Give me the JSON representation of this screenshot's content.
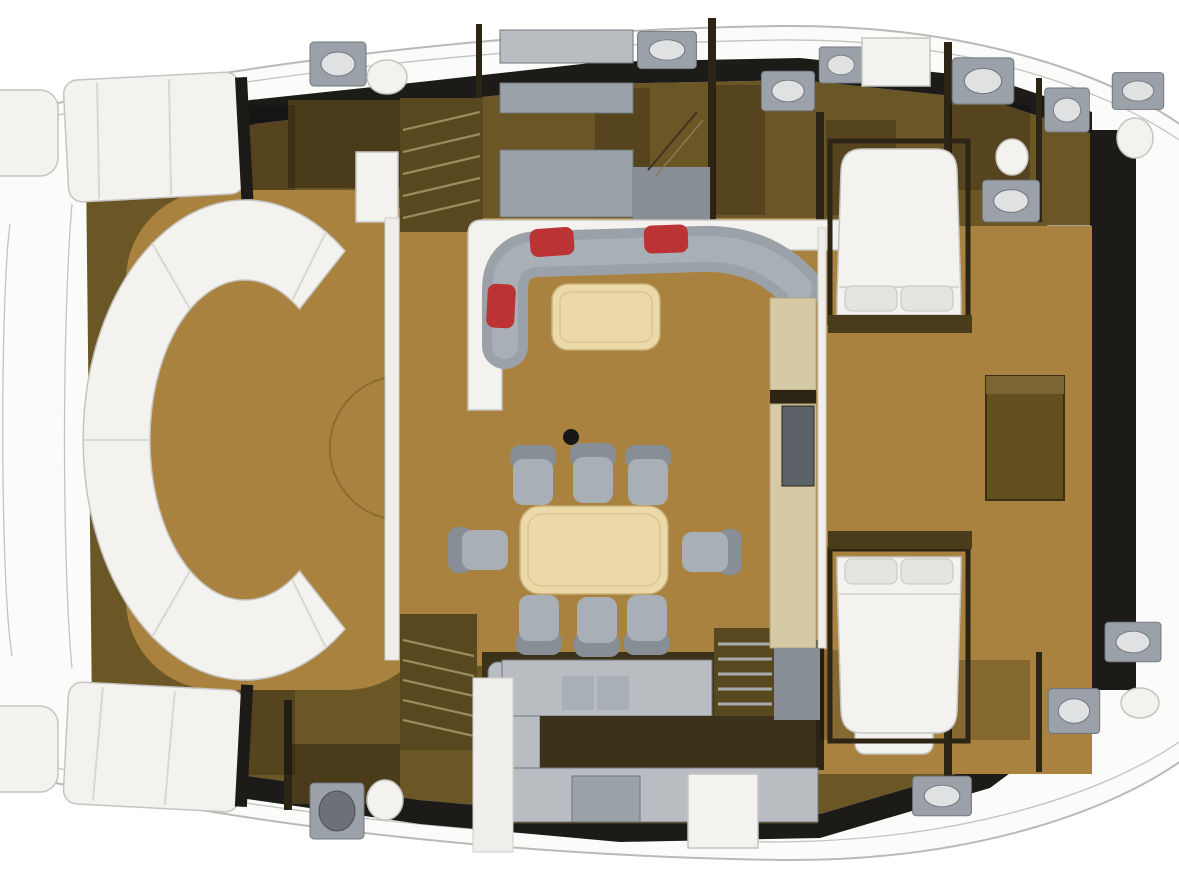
{
  "meta": {
    "description": "Top-down 3D rendered deck floor plan of a luxury catamaran yacht; no visible text in the image",
    "canvas_width": "1179",
    "canvas_height": "881"
  },
  "colors": {
    "background": "#ffffff",
    "hull": "#fbfbfa",
    "hullStroke": "#b9b9b6",
    "deckBand": "#1c1b18",
    "cabinBrown": "#6b5626",
    "cabinShadow": "#4a3c1b",
    "wallDark": "#2c2414",
    "floorTan": "#a8823e",
    "floorTanDark": "#8a6c2f",
    "galleyDark": "#3c321a",
    "furnWhite": "#f3f2ef",
    "furnWhiteStroke": "#c5c4c0",
    "gray": "#9aa1a8",
    "grayLight": "#b9bdc2",
    "grayMid": "#878e96",
    "graySeat": "#a8afb6",
    "grayDark": "#70767c",
    "cream": "#ecd9aa",
    "creamStroke": "#c9af76",
    "wallCream": "#d6c9a6",
    "redCushion": "#bc3336",
    "pillow": "#e3e3e0",
    "fixture": "#dfe1e2",
    "black": "#161616",
    "stairBg": "#58481f",
    "stairLine": "#9b8a5e"
  },
  "regions": [
    {
      "id": "bow-lounge",
      "label": "forward cockpit with curved white sofa"
    },
    {
      "id": "bow-sun-pads",
      "label": "two white sun pads / trampolines at bow"
    },
    {
      "id": "salon-lounge",
      "label": "L-shaped gray sofa with red cushions and coffee table"
    },
    {
      "id": "dining-area",
      "label": "dining table with eight chairs"
    },
    {
      "id": "galley",
      "label": "U-shaped gray galley counters with fridge"
    },
    {
      "id": "port-cabin-row",
      "label": "upper hull cabins with heads and basins"
    },
    {
      "id": "starboard-cabin-row",
      "label": "lower hull cabins with heads and basins"
    },
    {
      "id": "master-cabin",
      "label": "double bed cabin upper right"
    },
    {
      "id": "guest-cabin",
      "label": "double bed cabin lower right"
    },
    {
      "id": "desk-area",
      "label": "wooden desk on right corridor"
    },
    {
      "id": "side-deck",
      "label": "right side deck with black walkway band and cleats"
    },
    {
      "id": "stairways",
      "label": "three stairways between decks"
    }
  ],
  "inventory": {
    "dining_chairs": "8",
    "red_accent_cushions": "3",
    "double_beds": "2",
    "sun_pads": "2",
    "deck_cleats": "4",
    "stairways": "3",
    "wash_basins": "12",
    "toilets": "5"
  }
}
